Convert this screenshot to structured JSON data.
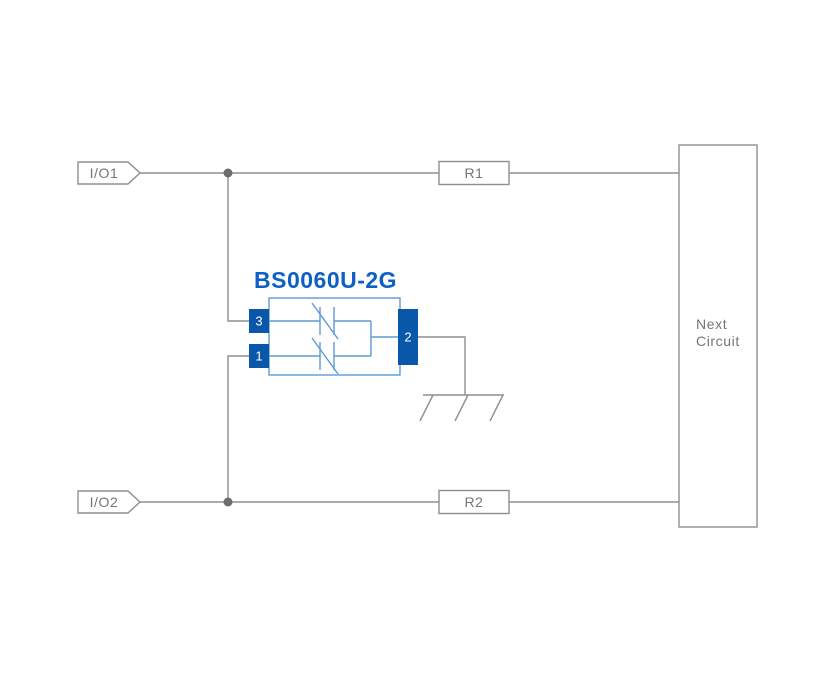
{
  "diagram": {
    "component": {
      "title": "BS0060U-2G",
      "pins": [
        {
          "number": "3",
          "position": "left-top"
        },
        {
          "number": "1",
          "position": "left-bottom"
        },
        {
          "number": "2",
          "position": "right"
        }
      ],
      "internal_symbols": [
        "bidirectional-tvs-diode",
        "bidirectional-tvs-diode"
      ]
    },
    "io_tags": [
      {
        "label": "I/O1"
      },
      {
        "label": "I/O2"
      }
    ],
    "resistors": [
      {
        "label": "R1"
      },
      {
        "label": "R2"
      }
    ],
    "next_circuit": {
      "line1": "Next",
      "line2": "Circuit"
    },
    "ground": {
      "icon": "chassis-ground-icon"
    },
    "colors": {
      "background": "#ffffff",
      "wire": "#8f8f8f",
      "label": "#757575",
      "junction": "#6d6d6d",
      "component_outline": "#5b9bd5",
      "pin_fill": "#0857a8",
      "pin_text": "#ffffff",
      "title": "#0e61c4"
    }
  }
}
